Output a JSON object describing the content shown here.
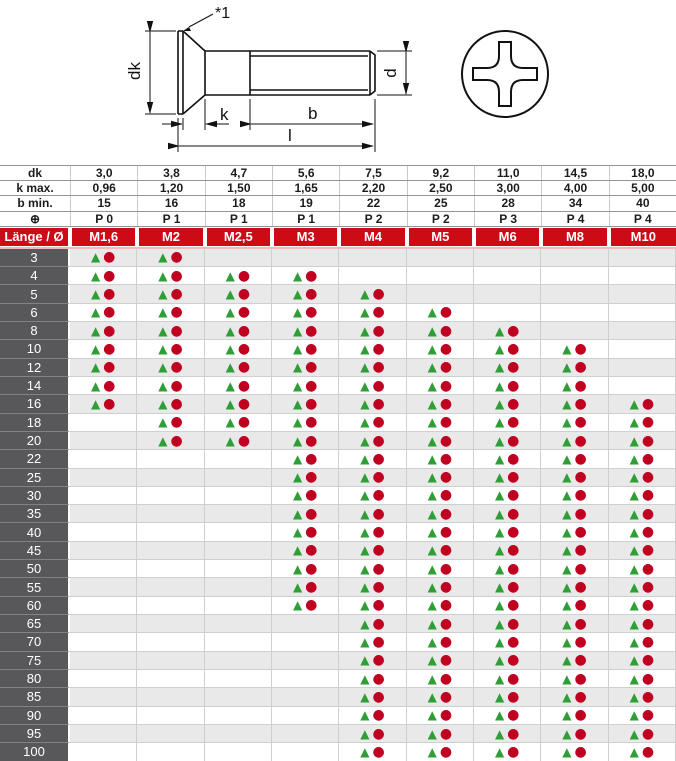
{
  "drawing": {
    "note": "*1",
    "dim_labels": {
      "dk": "dk",
      "k": "k",
      "b": "b",
      "l": "l",
      "d": "d"
    }
  },
  "legend_markers": {
    "triangle": "▲",
    "circle": "●"
  },
  "colors": {
    "header_red": "#cc0b17",
    "label_gray": "#58585a",
    "row_alt_gray": "#e9e9e9",
    "triangle_green": "#2f9e37",
    "circle_red": "#c00021",
    "pink_divider": "#f4b8bc"
  },
  "table": {
    "corner_label": "Länge / Ø",
    "columns": [
      "M1,6",
      "M2",
      "M2,5",
      "M3",
      "M4",
      "M5",
      "M6",
      "M8",
      "M10"
    ],
    "spec_rows": [
      {
        "label": "dk",
        "values": [
          "3,0",
          "3,8",
          "4,7",
          "5,6",
          "7,5",
          "9,2",
          "11,0",
          "14,5",
          "18,0"
        ]
      },
      {
        "label": "k max.",
        "values": [
          "0,96",
          "1,20",
          "1,50",
          "1,65",
          "2,20",
          "2,50",
          "3,00",
          "4,00",
          "5,00"
        ]
      },
      {
        "label": "b min.",
        "values": [
          "15",
          "16",
          "18",
          "19",
          "22",
          "25",
          "28",
          "34",
          "40"
        ]
      },
      {
        "label": "⊕",
        "values": [
          "P 0",
          "P 1",
          "P 1",
          "P 1",
          "P 2",
          "P 2",
          "P 3",
          "P 4",
          "P 4"
        ]
      }
    ],
    "rows": [
      {
        "length": "3",
        "available": [
          1,
          1,
          0,
          0,
          0,
          0,
          0,
          0,
          0
        ]
      },
      {
        "length": "4",
        "available": [
          1,
          1,
          1,
          1,
          0,
          0,
          0,
          0,
          0
        ]
      },
      {
        "length": "5",
        "available": [
          1,
          1,
          1,
          1,
          1,
          0,
          0,
          0,
          0
        ]
      },
      {
        "length": "6",
        "available": [
          1,
          1,
          1,
          1,
          1,
          1,
          0,
          0,
          0
        ]
      },
      {
        "length": "8",
        "available": [
          1,
          1,
          1,
          1,
          1,
          1,
          1,
          0,
          0
        ]
      },
      {
        "length": "10",
        "available": [
          1,
          1,
          1,
          1,
          1,
          1,
          1,
          1,
          0
        ]
      },
      {
        "length": "12",
        "available": [
          1,
          1,
          1,
          1,
          1,
          1,
          1,
          1,
          0
        ]
      },
      {
        "length": "14",
        "available": [
          1,
          1,
          1,
          1,
          1,
          1,
          1,
          1,
          0
        ]
      },
      {
        "length": "16",
        "available": [
          1,
          1,
          1,
          1,
          1,
          1,
          1,
          1,
          1
        ]
      },
      {
        "length": "18",
        "available": [
          0,
          1,
          1,
          1,
          1,
          1,
          1,
          1,
          1
        ]
      },
      {
        "length": "20",
        "available": [
          0,
          1,
          1,
          1,
          1,
          1,
          1,
          1,
          1
        ]
      },
      {
        "length": "22",
        "available": [
          0,
          0,
          0,
          1,
          1,
          1,
          1,
          1,
          1
        ]
      },
      {
        "length": "25",
        "available": [
          0,
          0,
          0,
          1,
          1,
          1,
          1,
          1,
          1
        ]
      },
      {
        "length": "30",
        "available": [
          0,
          0,
          0,
          1,
          1,
          1,
          1,
          1,
          1
        ]
      },
      {
        "length": "35",
        "available": [
          0,
          0,
          0,
          1,
          1,
          1,
          1,
          1,
          1
        ]
      },
      {
        "length": "40",
        "available": [
          0,
          0,
          0,
          1,
          1,
          1,
          1,
          1,
          1
        ]
      },
      {
        "length": "45",
        "available": [
          0,
          0,
          0,
          1,
          1,
          1,
          1,
          1,
          1
        ]
      },
      {
        "length": "50",
        "available": [
          0,
          0,
          0,
          1,
          1,
          1,
          1,
          1,
          1
        ]
      },
      {
        "length": "55",
        "available": [
          0,
          0,
          0,
          1,
          1,
          1,
          1,
          1,
          1
        ]
      },
      {
        "length": "60",
        "available": [
          0,
          0,
          0,
          1,
          1,
          1,
          1,
          1,
          1
        ]
      },
      {
        "length": "65",
        "available": [
          0,
          0,
          0,
          0,
          1,
          1,
          1,
          1,
          1
        ]
      },
      {
        "length": "70",
        "available": [
          0,
          0,
          0,
          0,
          1,
          1,
          1,
          1,
          1
        ]
      },
      {
        "length": "75",
        "available": [
          0,
          0,
          0,
          0,
          1,
          1,
          1,
          1,
          1
        ]
      },
      {
        "length": "80",
        "available": [
          0,
          0,
          0,
          0,
          1,
          1,
          1,
          1,
          1
        ]
      },
      {
        "length": "85",
        "available": [
          0,
          0,
          0,
          0,
          1,
          1,
          1,
          1,
          1
        ]
      },
      {
        "length": "90",
        "available": [
          0,
          0,
          0,
          0,
          1,
          1,
          1,
          1,
          1
        ]
      },
      {
        "length": "95",
        "available": [
          0,
          0,
          0,
          0,
          1,
          1,
          1,
          1,
          1
        ]
      },
      {
        "length": "100",
        "available": [
          0,
          0,
          0,
          0,
          1,
          1,
          1,
          1,
          1
        ]
      }
    ]
  }
}
